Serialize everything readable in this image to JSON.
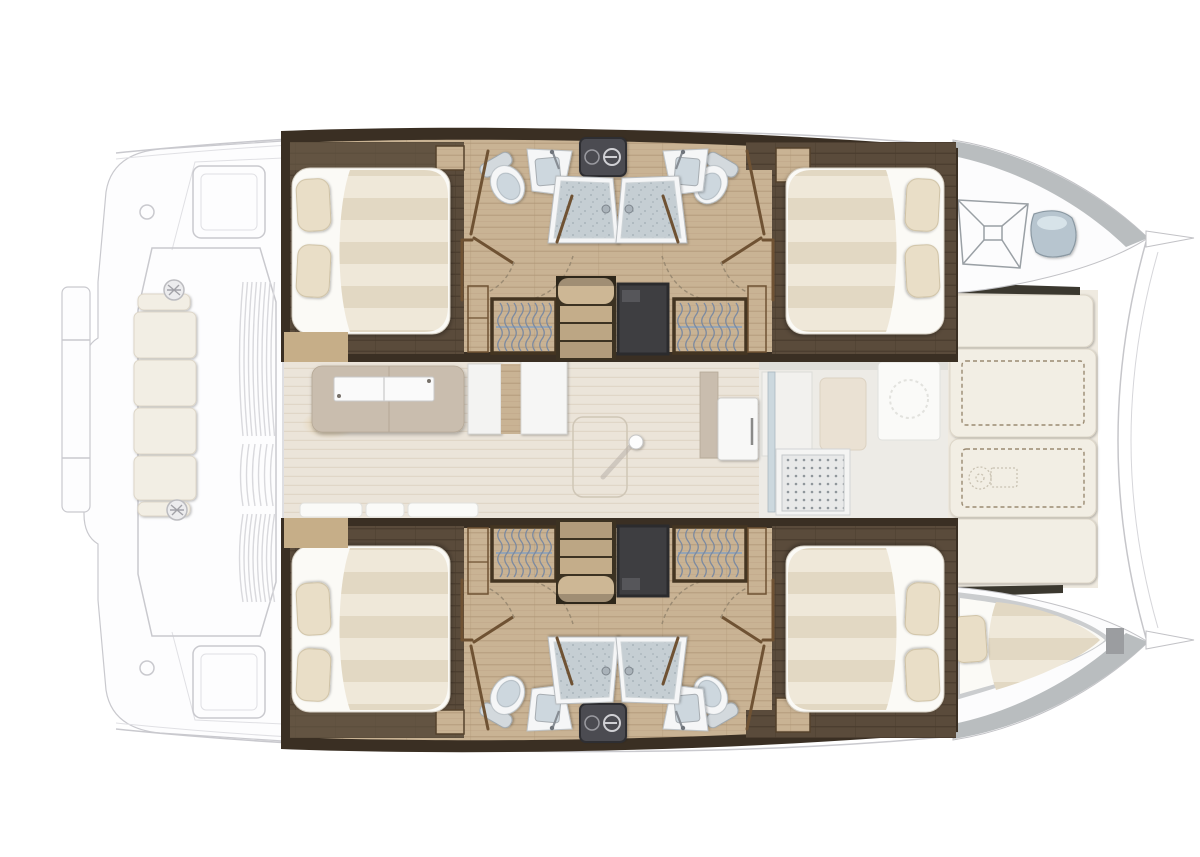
{
  "meta": {
    "title": "Catamaran yacht interior layout plan, top view, bow to the right",
    "diagram_type": "boat floor plan",
    "vessel": "sailing catamaran",
    "text_labels": []
  },
  "colors": {
    "wall": "#3a2f23",
    "wood": "#c9b394",
    "woodLn": "#ac9171",
    "dkwood": "#5a4b3b",
    "dkwoodLn": "#483b2d",
    "partition": "#6f5233",
    "stripeA": "#efe8d9",
    "stripeB": "#e2d8c3",
    "bedWhite": "#fbfaf6",
    "pillow": "#e9dec7",
    "pillowLn": "#cfc2a5",
    "tech": "#3e3e41",
    "appl": "#4c4c51",
    "fixWhite": "#f5f6f7",
    "fixGray": "#cdd7de",
    "tray": "#c5ced3",
    "trayDot": "#a8b3ba",
    "saloon": "#ebe4d9",
    "saloonLn": "#e0d6c7",
    "galley": "#c9bdae",
    "deck": "#fcfcfd",
    "deckLn": "#c9c9ce",
    "cushion": "#f2eee4",
    "cushLn": "#ddd6c8",
    "hullGray": "#b9bdbf",
    "bluePad": "#b7c5cf",
    "grate": "#e8e9e9",
    "grateDot": "#8f969b",
    "dash": "#9a8a72",
    "glow": "#e0c48f",
    "woodStep": "#c6ae88",
    "crewFloor": "#cbcdcf"
  },
  "features": {
    "double_cabins": 4,
    "bathrooms": 4,
    "shower_stalls": 4,
    "toilets": 4,
    "washbasins": 4,
    "wardrobes": 4,
    "companionway_stairs": 2,
    "crew_bow_berth": 1,
    "anchor_locker": 1,
    "saloon_galley": 1,
    "foredeck_sunpads": 4,
    "aft_cockpit_seat_cushions": 4,
    "winches": 2
  },
  "legend": {
    "left_side": "aft cockpit and swim platforms (exterior, faded)",
    "center": "saloon with galley and forward cockpit",
    "right_side": "bows with anchor locker and crew berth",
    "hulls": "each hull: two double cabins, two bathrooms with shower, wardrobes, stairs"
  }
}
